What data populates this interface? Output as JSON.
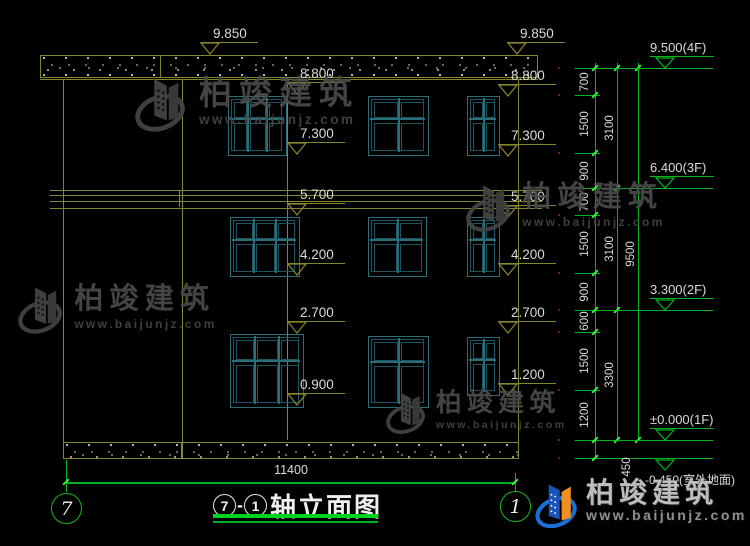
{
  "colors": {
    "facade_line": "#86862c",
    "window_frame": "#2a6e7a",
    "window_inner": "#1d5560",
    "dim_green": "#00b41e",
    "tick_green": "#3cf03c",
    "text": "#dadada",
    "watermark_gray": "#4a4a4a",
    "logo_blue": "#1a6fd4",
    "logo_deep_blue": "#0d47a1",
    "logo_orange": "#f0901e",
    "title_underline": "#00d41e"
  },
  "drawing": {
    "title": {
      "axis_left": "7",
      "separator": "-",
      "axis_right": "1",
      "name": "轴立面图"
    },
    "axis_bubbles": {
      "left": "7",
      "right": "1"
    },
    "bottom_dimension": "11400",
    "facade_level_marks": [
      {
        "label": "9.850",
        "x": 210,
        "y": 55
      },
      {
        "label": "9.850",
        "x": 517,
        "y": 55
      },
      {
        "label": "8.800",
        "x": 297,
        "y": 95
      },
      {
        "label": "8.800",
        "x": 508,
        "y": 97
      },
      {
        "label": "7.300",
        "x": 297,
        "y": 155
      },
      {
        "label": "7.300",
        "x": 508,
        "y": 157
      },
      {
        "label": "5.700",
        "x": 297,
        "y": 216
      },
      {
        "label": "5.700",
        "x": 508,
        "y": 218
      },
      {
        "label": "4.200",
        "x": 297,
        "y": 276
      },
      {
        "label": "4.200",
        "x": 508,
        "y": 276
      },
      {
        "label": "2.700",
        "x": 297,
        "y": 334
      },
      {
        "label": "2.700",
        "x": 508,
        "y": 334
      },
      {
        "label": "0.900",
        "x": 297,
        "y": 406
      },
      {
        "label": "1.200",
        "x": 508,
        "y": 396
      }
    ],
    "right_level_marks": [
      {
        "label": "9.500(4F)",
        "y": 68,
        "below": false
      },
      {
        "label": "6.400(3F)",
        "y": 188,
        "below": false
      },
      {
        "label": "3.300(2F)",
        "y": 310,
        "below": false
      },
      {
        "label": "±0.000(1F)",
        "y": 440,
        "below": false
      },
      {
        "label": "-0.450(室外地面)",
        "y": 458,
        "below": true
      }
    ],
    "dim_chain": {
      "boundaries": [
        68,
        95,
        153,
        188,
        215,
        273,
        310,
        332,
        390,
        440,
        458
      ],
      "labels": [
        "700",
        "1500",
        "900",
        "700",
        "1500",
        "900",
        "600",
        "1500",
        "1200",
        "450"
      ],
      "subtotals": [
        {
          "label": "3100",
          "y1": 68,
          "y2": 188
        },
        {
          "label": "3100",
          "y1": 188,
          "y2": 310
        },
        {
          "label": "3300",
          "y1": 310,
          "y2": 440
        }
      ],
      "total": {
        "label": "9500",
        "y1": 68,
        "y2": 440
      }
    },
    "windows": [
      {
        "x": 228,
        "y": 96,
        "w": 57,
        "h": 58,
        "cols": 3,
        "t": 0.38
      },
      {
        "x": 368,
        "y": 96,
        "w": 59,
        "h": 58,
        "cols": 2,
        "t": 0.38
      },
      {
        "x": 467,
        "y": 96,
        "w": 31,
        "h": 58,
        "cols": 2,
        "t": 0.38
      },
      {
        "x": 230,
        "y": 217,
        "w": 68,
        "h": 58,
        "cols": 3,
        "t": 0.38
      },
      {
        "x": 368,
        "y": 217,
        "w": 57,
        "h": 58,
        "cols": 2,
        "t": 0.38
      },
      {
        "x": 467,
        "y": 217,
        "w": 31,
        "h": 58,
        "cols": 2,
        "t": 0.38
      },
      {
        "x": 230,
        "y": 334,
        "w": 72,
        "h": 72,
        "cols": 3,
        "t": 0.36
      },
      {
        "x": 368,
        "y": 336,
        "w": 59,
        "h": 70,
        "cols": 2,
        "t": 0.36
      },
      {
        "x": 467,
        "y": 337,
        "w": 31,
        "h": 57,
        "cols": 2,
        "t": 0.38
      }
    ]
  },
  "watermark": {
    "brand": "柏竣建筑",
    "url": "www.baijunjz.com",
    "positions": [
      {
        "x": 135,
        "y": 74,
        "s": 1.0
      },
      {
        "x": 18,
        "y": 283,
        "s": 0.88
      },
      {
        "x": 466,
        "y": 181,
        "s": 0.88
      },
      {
        "x": 386,
        "y": 389,
        "s": 0.78
      }
    ]
  },
  "logo": {
    "brand": "柏竣建筑",
    "url": "www.baijunjz.com"
  }
}
